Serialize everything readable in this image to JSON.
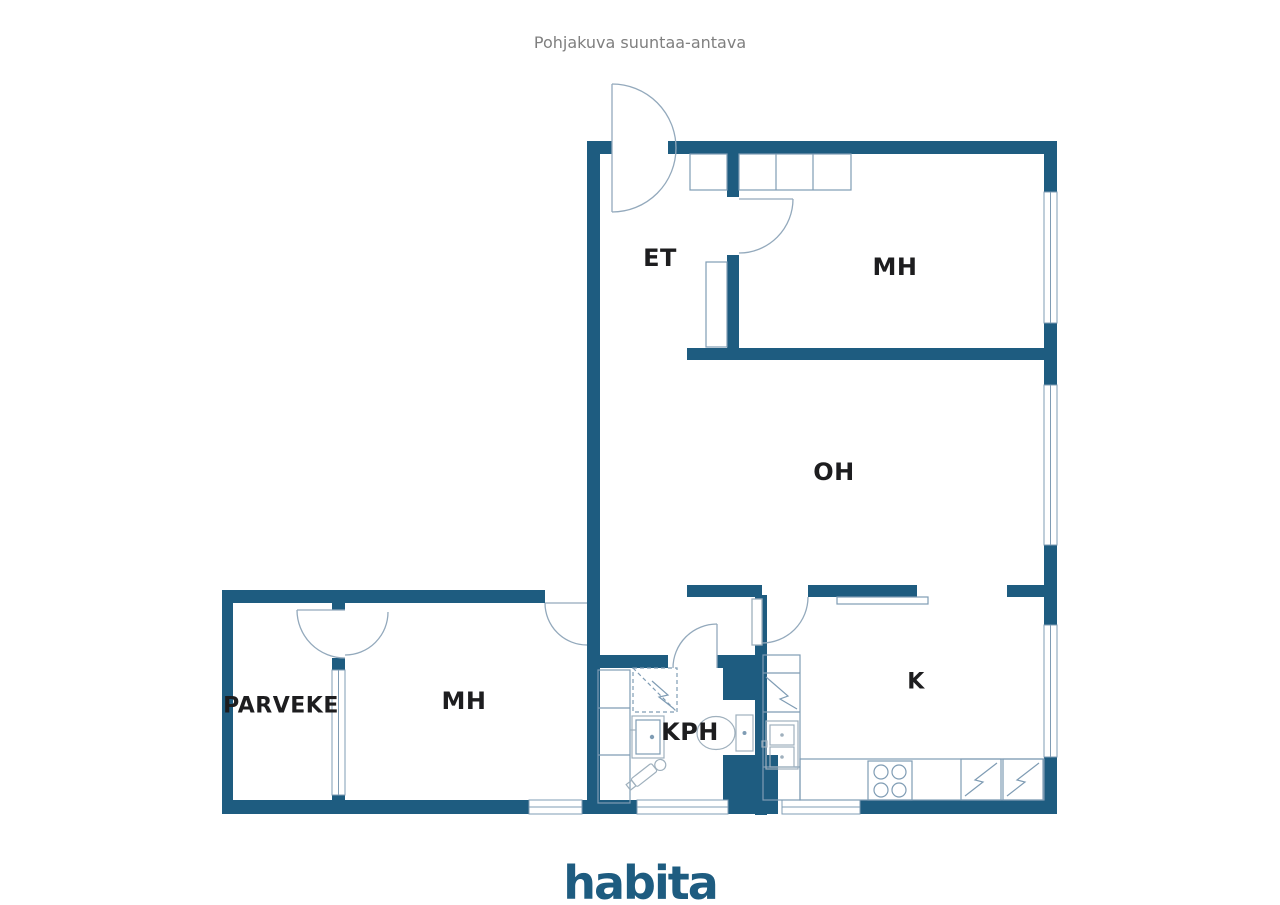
{
  "title": "Pohjakuva suuntaa-antava",
  "rooms": {
    "entry": "ET",
    "bedroom_top": "MH",
    "living": "OH",
    "bedroom_bottom": "MH",
    "bathroom": "KPH",
    "kitchen": "K",
    "balcony": "PARVEKE"
  },
  "brand": {
    "logo": "habita"
  },
  "colors": {
    "wall": "#1e5c80",
    "line": "#7f9cb4",
    "arc": "#93a9bc",
    "fixture": "#9fb0bd",
    "label": "#1d1d1f",
    "title": "#7f7f7f",
    "background": "#ffffff"
  }
}
